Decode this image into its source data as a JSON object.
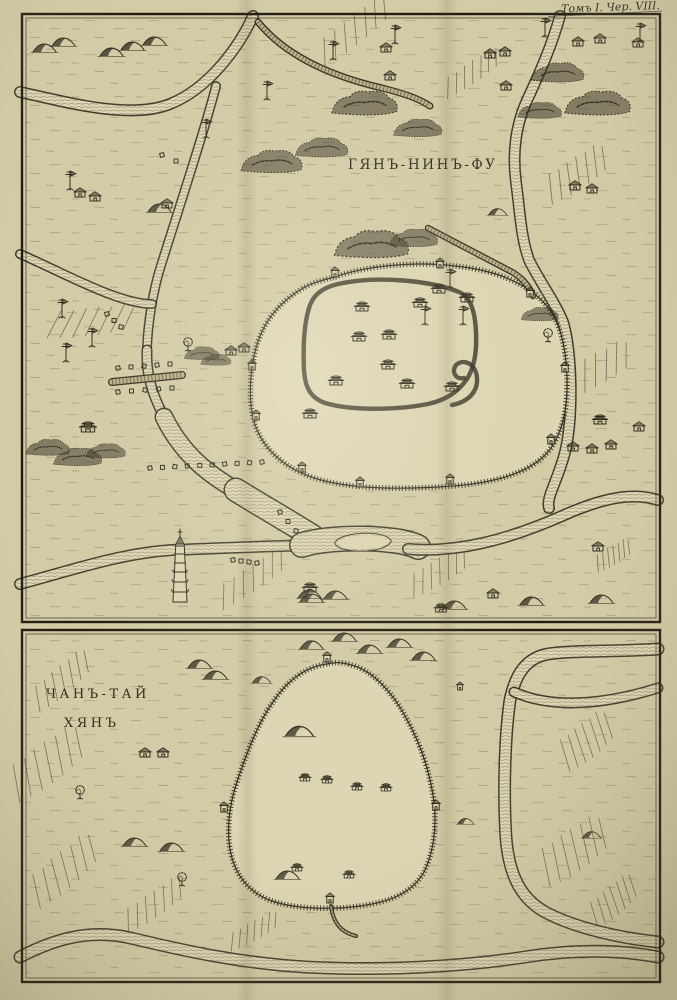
{
  "page": {
    "header": "Томъ I. Чер. VIII."
  },
  "colors": {
    "paper": "#d2cba6",
    "paper-light": "#ddd6b4",
    "paper-dark": "#b9b08a",
    "ink": "#2f2a1e",
    "ink-soft": "#6a614a",
    "frame": "#1f1a10"
  },
  "panels": {
    "top": {
      "label": "ГЯНЪ-НИНЪ-ФУ"
    },
    "bottom": {
      "label_line1": "ЧАНЪ-ТАЙ",
      "label_line2": "ХЯНЪ"
    }
  },
  "map": {
    "top": {
      "fields": [
        [
          352,
          32,
          85,
          26,
          -38
        ],
        [
          470,
          74,
          65,
          20,
          -34
        ],
        [
          575,
          175,
          70,
          30,
          -33
        ],
        [
          592,
          372,
          80,
          30,
          -28
        ],
        [
          250,
          580,
          78,
          24,
          -34
        ],
        [
          437,
          573,
          65,
          24,
          -30
        ],
        [
          88,
          322,
          85,
          28,
          -6
        ],
        [
          612,
          556,
          40,
          18,
          -30
        ]
      ],
      "rivers": [
        {
          "d": "M253,16 C240,45 210,88 170,104 C130,120 66,102 20,92",
          "w": 12
        },
        {
          "d": "M560,16 C552,45 540,72 529,96 C516,122 512,152 516,182 C520,212 521,238 529,260 C541,284 555,302 563,322 C572,350 574,420 564,456 C556,484 546,498 549,508",
          "w": 12
        },
        {
          "d": "M216,86 C205,130 175,220 159,272 C153,293 148,322 147,348",
          "w": 10
        },
        {
          "d": "M152,304 C118,304 62,272 20,254",
          "w": 10
        },
        {
          "d": "M147,350 C146,374 152,394 164,417",
          "w": 11
        },
        {
          "d": "M164,417 C180,450 204,472 236,490",
          "w": 19
        },
        {
          "d": "M236,490 C262,506 288,521 312,536",
          "w": 25
        },
        {
          "d": "M20,584 C72,570 122,553 172,550 C225,548 268,546 318,545",
          "w": 12
        },
        {
          "d": "M302,545 C330,536 396,536 418,547",
          "w": 26
        },
        {
          "d": "M336,543 C342,533 384,531 390,541 C385,552 341,553 336,543 Z",
          "w": 3.5,
          "fill": true
        },
        {
          "d": "M408,549 C455,553 505,541 562,516 C602,498 632,492 658,500",
          "w": 12
        }
      ],
      "walls": [
        {
          "d": "M335,277 C365,266 415,261 455,266 C495,270 527,283 546,305 C560,321 566,347 567,378 C568,408 562,436 547,453 C528,474 492,483 452,486 C412,489 362,490 325,481 C292,473 268,455 257,430 C248,409 249,378 255,352 C261,326 276,305 300,290 C312,282 324,280 335,277 Z"
        }
      ],
      "rings": [
        {
          "d": "M338,284 C378,275 432,281 459,292 C471,297 475,312 476,332 C477,352 474,368 467,379 C458,392 446,400 428,404 C398,410 352,411 325,403 C311,398 305,388 304,370 C303,348 304,322 310,305 C315,292 326,287 338,284 Z"
        },
        {
          "d": "M452,405 C468,402 478,392 477,378 C476,364 464,358 456,365 C451,372 456,380 464,378"
        }
      ],
      "roads": [
        {
          "d": "M112,382 L182,375",
          "w": 8
        },
        {
          "d": "M258,22 C285,55 330,76 382,88 C402,93 418,98 430,106",
          "w": 7
        },
        {
          "d": "M428,228 C455,242 485,258 512,272 C524,279 530,288 533,296",
          "w": 6.5
        }
      ],
      "dots": [
        {
          "x1": 150,
          "y1": 468,
          "x2": 262,
          "y2": 462,
          "n": 10
        },
        {
          "x1": 280,
          "y1": 512,
          "x2": 296,
          "y2": 531,
          "n": 3
        },
        {
          "x1": 233,
          "y1": 560,
          "x2": 257,
          "y2": 563,
          "n": 4
        },
        {
          "x1": 107,
          "y1": 314,
          "x2": 121,
          "y2": 327,
          "n": 3
        },
        {
          "x1": 118,
          "y1": 368,
          "x2": 170,
          "y2": 364,
          "n": 5
        },
        {
          "x1": 118,
          "y1": 392,
          "x2": 172,
          "y2": 388,
          "n": 5
        },
        {
          "x1": 162,
          "y1": 155,
          "x2": 176,
          "y2": 161,
          "n": 2
        }
      ],
      "markers": [
        [
          "hill",
          45,
          52
        ],
        [
          "hill",
          64,
          46
        ],
        [
          "hill",
          112,
          56
        ],
        [
          "hill",
          133,
          50
        ],
        [
          "hill",
          155,
          45
        ],
        [
          "hill",
          160,
          212
        ],
        [
          "hill",
          498,
          215,
          0.8
        ],
        [
          "hill",
          312,
          602
        ],
        [
          "hill",
          336,
          599
        ],
        [
          "hill",
          455,
          609
        ],
        [
          "hill",
          532,
          605
        ],
        [
          "hill",
          602,
          603
        ],
        [
          "hill",
          310,
          598
        ],
        [
          "bigbush",
          272,
          168,
          1.4
        ],
        [
          "bigbush",
          322,
          153,
          1.2
        ],
        [
          "bigbush",
          365,
          110,
          1.5
        ],
        [
          "bigbush",
          418,
          133,
          1.1
        ],
        [
          "bigbush",
          558,
          78,
          1.2
        ],
        [
          "bigbush",
          598,
          110,
          1.5
        ],
        [
          "bigbush",
          540,
          115,
          1
        ],
        [
          "bigbush",
          372,
          252,
          1.7
        ],
        [
          "bigbush",
          414,
          243,
          1.1
        ],
        [
          "bigbush",
          540,
          318,
          0.85
        ],
        [
          "bigbush",
          48,
          452,
          1
        ],
        [
          "bigbush",
          78,
          462,
          1.1
        ],
        [
          "bigbush",
          106,
          455,
          0.9
        ],
        [
          "bigbush",
          202,
          357,
          0.8
        ],
        [
          "bigbush",
          216,
          363,
          0.7
        ],
        [
          "tree",
          188,
          351
        ],
        [
          "tree",
          548,
          342
        ],
        [
          "house",
          80,
          197
        ],
        [
          "house",
          95,
          201
        ],
        [
          "house",
          167,
          208
        ],
        [
          "house",
          386,
          52
        ],
        [
          "house",
          390,
          80
        ],
        [
          "house",
          506,
          90
        ],
        [
          "house",
          490,
          58
        ],
        [
          "house",
          505,
          56
        ],
        [
          "house",
          575,
          190
        ],
        [
          "house",
          592,
          193
        ],
        [
          "house",
          578,
          46
        ],
        [
          "house",
          600,
          43
        ],
        [
          "house",
          638,
          47
        ],
        [
          "house",
          598,
          551
        ],
        [
          "house",
          573,
          451
        ],
        [
          "house",
          592,
          453
        ],
        [
          "house",
          611,
          449
        ],
        [
          "house",
          639,
          431
        ],
        [
          "house",
          231,
          355
        ],
        [
          "house",
          244,
          352
        ],
        [
          "house",
          493,
          598
        ],
        [
          "temple",
          362,
          311
        ],
        [
          "temple",
          420,
          307
        ],
        [
          "temple",
          439,
          293
        ],
        [
          "temple",
          467,
          302
        ],
        [
          "temple",
          359,
          341
        ],
        [
          "temple",
          389,
          339
        ],
        [
          "temple",
          388,
          369
        ],
        [
          "temple",
          336,
          385
        ],
        [
          "temple",
          407,
          388
        ],
        [
          "temple",
          452,
          391
        ],
        [
          "temple",
          310,
          418
        ],
        [
          "temple",
          600,
          424
        ],
        [
          "temple",
          88,
          432,
          1.1
        ],
        [
          "temple",
          310,
          592
        ],
        [
          "temple",
          441,
          612,
          0.9
        ],
        [
          "tower",
          335,
          277
        ],
        [
          "tower",
          440,
          268
        ],
        [
          "tower",
          530,
          297
        ],
        [
          "tower",
          565,
          372
        ],
        [
          "tower",
          551,
          444
        ],
        [
          "tower",
          450,
          484
        ],
        [
          "tower",
          360,
          487
        ],
        [
          "tower",
          302,
          472
        ],
        [
          "tower",
          256,
          420
        ],
        [
          "tower",
          252,
          370
        ],
        [
          "pole",
          395,
          44
        ],
        [
          "pole",
          545,
          37
        ],
        [
          "pole",
          640,
          42
        ],
        [
          "pole",
          267,
          100
        ],
        [
          "pole",
          206,
          138
        ],
        [
          "pole",
          70,
          190
        ],
        [
          "pole",
          62,
          318
        ],
        [
          "pole",
          92,
          347
        ],
        [
          "pole",
          66,
          362
        ],
        [
          "pole",
          463,
          325
        ],
        [
          "pole",
          425,
          325
        ],
        [
          "pole",
          450,
          288
        ],
        [
          "pole",
          333,
          60
        ],
        [
          "pagoda",
          180,
          602
        ]
      ]
    },
    "bottom": {
      "fields": [
        [
          60,
          682,
          70,
          26,
          -40
        ],
        [
          45,
          765,
          85,
          38,
          -36
        ],
        [
          62,
          872,
          80,
          34,
          -40
        ],
        [
          152,
          906,
          70,
          24,
          -34
        ],
        [
          585,
          742,
          60,
          34,
          -38
        ],
        [
          572,
          852,
          75,
          40,
          -34
        ],
        [
          612,
          902,
          55,
          28,
          -40
        ],
        [
          252,
          932,
          55,
          18,
          -28
        ]
      ],
      "rivers": [
        {
          "d": "M658,649 C615,652 575,650 548,654 C525,658 515,676 510,700 C505,735 503,790 506,838 C509,874 520,898 545,912 C575,928 620,938 658,942",
          "w": 13
        },
        {
          "d": "M514,692 C550,708 600,706 658,688",
          "w": 11
        },
        {
          "d": "M20,957 C60,936 95,929 135,939 C185,951 240,963 305,967 C380,971 460,967 525,957 C575,949 620,950 658,957",
          "w": 13
        }
      ],
      "walls": [
        {
          "d": "M327,664 C305,667 287,681 273,702 C258,723 247,752 237,782 C228,808 226,836 232,858 C238,879 252,894 272,901 C295,909 330,910 360,906 C390,902 412,893 424,872 C433,854 437,828 434,802 C430,772 420,742 405,716 C392,692 372,670 351,665 C342,662 334,662 327,664 Z"
        }
      ],
      "roads": [
        {
          "d": "M331,906 C333,922 340,932 356,936",
          "w": 4
        }
      ],
      "markers": [
        [
          "hill",
          312,
          649
        ],
        [
          "hill",
          345,
          641
        ],
        [
          "hill",
          370,
          653
        ],
        [
          "hill",
          400,
          647
        ],
        [
          "hill",
          424,
          660
        ],
        [
          "hill",
          200,
          668
        ],
        [
          "hill",
          216,
          679
        ],
        [
          "hill",
          262,
          683,
          0.8
        ],
        [
          "hill",
          300,
          736,
          1.2
        ],
        [
          "hill",
          288,
          879
        ],
        [
          "hill",
          135,
          846
        ],
        [
          "hill",
          172,
          851
        ],
        [
          "hill",
          466,
          824,
          0.7
        ],
        [
          "hill",
          592,
          838,
          0.8
        ],
        [
          "house",
          145,
          757
        ],
        [
          "house",
          163,
          757
        ],
        [
          "temple",
          305,
          781,
          0.8
        ],
        [
          "temple",
          327,
          783,
          0.8
        ],
        [
          "temple",
          357,
          790,
          0.8
        ],
        [
          "temple",
          386,
          791,
          0.8
        ],
        [
          "temple",
          297,
          871,
          0.8
        ],
        [
          "temple",
          349,
          878,
          0.8
        ],
        [
          "tower",
          327,
          662
        ],
        [
          "tower",
          330,
          903
        ],
        [
          "tower",
          224,
          812
        ],
        [
          "tower",
          436,
          810
        ],
        [
          "tower",
          460,
          690,
          0.8
        ],
        [
          "tree",
          182,
          886
        ],
        [
          "tree",
          80,
          799
        ]
      ]
    }
  }
}
